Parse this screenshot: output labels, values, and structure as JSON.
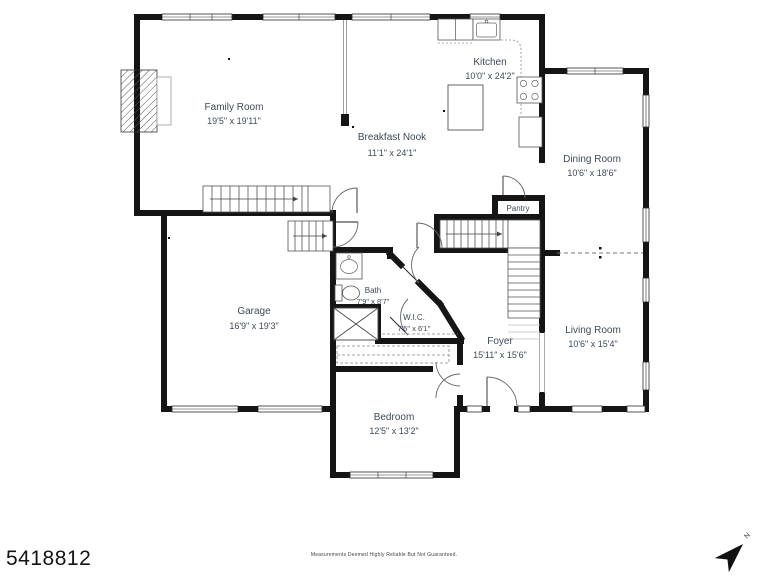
{
  "document": {
    "type": "floor-plan",
    "mls_number": "5418812",
    "disclaimer": "Measurements Deemed Highly Reliable But Not Guaranteed.",
    "compass_label": "N"
  },
  "rooms": {
    "family_room": {
      "name": "Family Room",
      "dims": "19'5\" x 19'11\""
    },
    "breakfast_nook": {
      "name": "Breakfast Nook",
      "dims": "11'1\" x 24'1\""
    },
    "kitchen": {
      "name": "Kitchen",
      "dims": "10'0\" x 24'2\""
    },
    "dining_room": {
      "name": "Dining Room",
      "dims": "10'6\" x 18'6\""
    },
    "pantry": {
      "name": "Pantry"
    },
    "garage": {
      "name": "Garage",
      "dims": "16'9\" x 19'3\""
    },
    "bath": {
      "name": "Bath",
      "dims": "7'9\" x 8'7\""
    },
    "wic": {
      "name": "W.I.C.",
      "dims": "7'5\" x 6'1\""
    },
    "foyer": {
      "name": "Foyer",
      "dims": "15'11\" x 15'6\""
    },
    "living_room": {
      "name": "Living Room",
      "dims": "10'6\" x 15'4\""
    },
    "bedroom": {
      "name": "Bedroom",
      "dims": "12'5\" x 13'2\""
    }
  }
}
